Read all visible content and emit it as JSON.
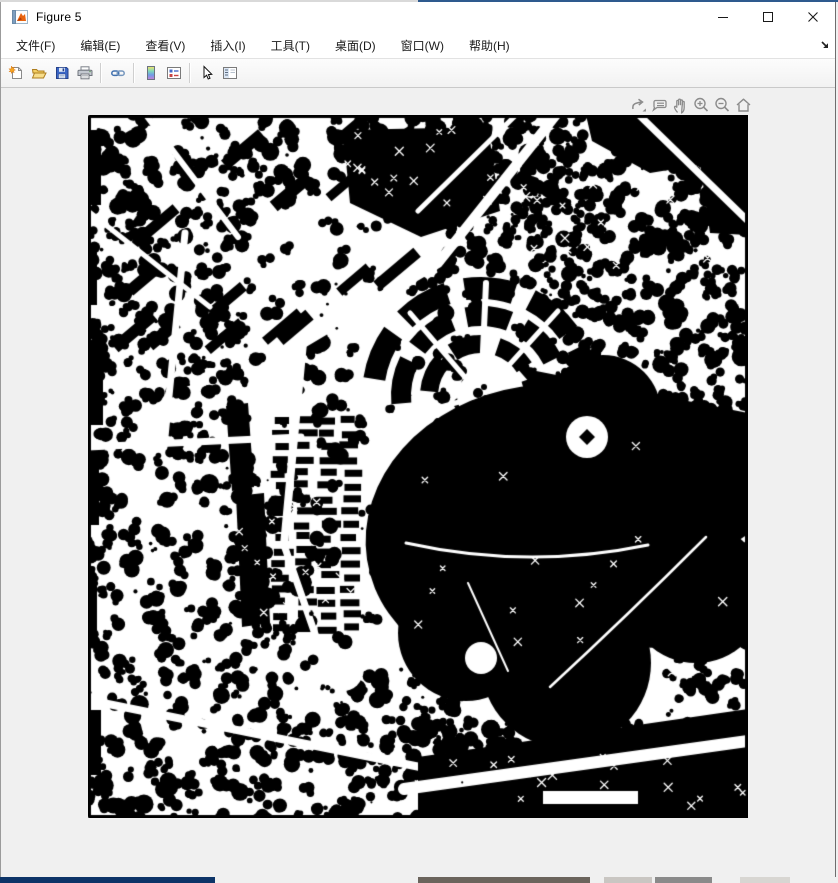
{
  "window": {
    "title": "Figure 5",
    "app_icon": "matlab-logo-icon",
    "controls": [
      {
        "name": "minimize-button",
        "icon": "minimize-icon"
      },
      {
        "name": "maximize-button",
        "icon": "maximize-icon"
      },
      {
        "name": "close-button",
        "icon": "close-icon"
      }
    ]
  },
  "menu_bar": {
    "items": [
      {
        "label": "文件(F)"
      },
      {
        "label": "编辑(E)"
      },
      {
        "label": "查看(V)"
      },
      {
        "label": "插入(I)"
      },
      {
        "label": "工具(T)"
      },
      {
        "label": "桌面(D)"
      },
      {
        "label": "窗口(W)"
      },
      {
        "label": "帮助(H)"
      }
    ],
    "dock_icon": "dock-figure-arrow-icon"
  },
  "toolbar": {
    "buttons": [
      {
        "name": "new-figure-button",
        "icon": "new-document-icon"
      },
      {
        "name": "open-file-button",
        "icon": "open-folder-icon"
      },
      {
        "name": "save-figure-button",
        "icon": "save-floppy-icon"
      },
      {
        "name": "print-figure-button",
        "icon": "printer-icon"
      },
      {
        "name": "link-plot-button",
        "icon": "chain-link-icon"
      },
      {
        "name": "insert-colorbar-button",
        "icon": "colorbar-icon"
      },
      {
        "name": "insert-legend-button",
        "icon": "legend-icon"
      },
      {
        "name": "edit-plot-button",
        "icon": "pointer-arrow-icon"
      },
      {
        "name": "property-inspector-button",
        "icon": "property-panel-icon"
      }
    ]
  },
  "axes_toolbar": {
    "buttons": [
      {
        "name": "export-button",
        "icon": "export-icon"
      },
      {
        "name": "datatips-button",
        "icon": "datatip-icon"
      },
      {
        "name": "pan-button",
        "icon": "pan-hand-icon"
      },
      {
        "name": "zoom-in-button",
        "icon": "zoom-in-icon"
      },
      {
        "name": "zoom-out-button",
        "icon": "zoom-out-icon"
      },
      {
        "name": "restore-view-button",
        "icon": "home-icon"
      }
    ]
  },
  "figure_image": {
    "name": "binary-map-image",
    "background_color": "#ffffff",
    "foreground_color": "#000000",
    "width": 660,
    "height": 703
  },
  "colors": {
    "titlebar_bg": "#ffffff",
    "toolbar_bg": "#f5f5f5",
    "client_bg": "#f0f0f0",
    "accent_strip": "#2e5a8e",
    "taskbar_strip": "#0d3468",
    "axes_icon_gray": "#8c8c8c"
  }
}
